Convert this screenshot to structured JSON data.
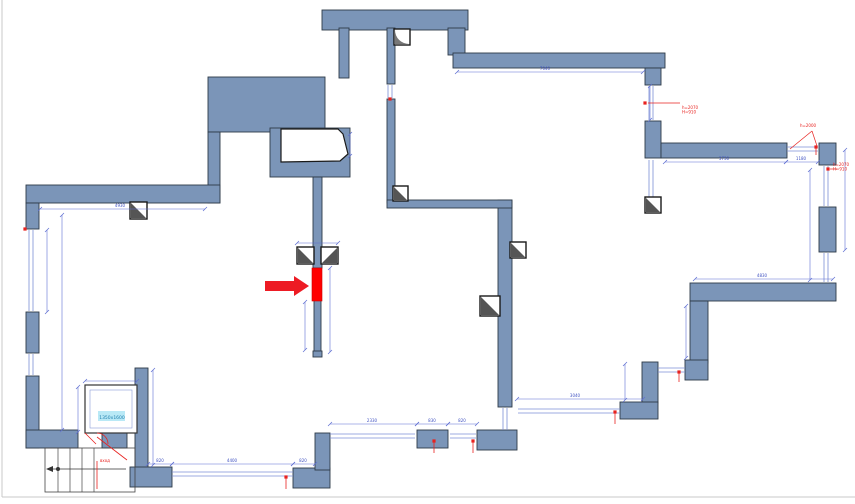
{
  "canvas": {
    "width": 855,
    "height": 504,
    "background": "#ffffff",
    "border_color": "#c9c9c9"
  },
  "colors": {
    "wall_fill": "#7b95b8",
    "wall_stroke": "#2e3a48",
    "thin_wall_fill": "#8aa2c2",
    "dim_line": "#5f6fd2",
    "dim_text": "#3f51c1",
    "window_line": "#7c8fd6",
    "red": "#e8221f",
    "arrow_red": "#ed1b24",
    "highlight_red": "#ff0000",
    "column_dark": "#555555",
    "stair_line": "#444444",
    "label_bg": "#b9e9f6",
    "label_text": "#1f7fae"
  },
  "floor_plan": {
    "walls": [
      [
        322,
        10,
        146,
        20
      ],
      [
        448,
        28,
        17,
        27
      ],
      [
        453,
        53,
        212,
        15
      ],
      [
        645,
        68,
        16,
        17
      ],
      [
        645,
        121,
        16,
        37
      ],
      [
        661,
        143,
        126,
        15
      ],
      [
        819,
        143,
        17,
        22
      ],
      [
        819,
        207,
        17,
        45
      ],
      [
        690,
        283,
        146,
        18
      ],
      [
        690,
        301,
        18,
        62
      ],
      [
        685,
        360,
        23,
        20
      ],
      [
        642,
        362,
        16,
        41
      ],
      [
        620,
        402,
        38,
        17
      ],
      [
        339,
        28,
        10,
        50
      ],
      [
        387,
        28,
        8,
        56
      ],
      [
        387,
        99,
        8,
        104
      ],
      [
        208,
        77,
        117,
        55
      ],
      [
        270,
        128,
        80,
        49
      ],
      [
        208,
        132,
        12,
        71
      ],
      [
        26,
        185,
        194,
        18
      ],
      [
        26,
        203,
        13,
        26
      ],
      [
        26,
        312,
        13,
        41
      ],
      [
        26,
        376,
        13,
        72
      ],
      [
        26,
        430,
        52,
        18
      ],
      [
        102,
        430,
        25,
        18
      ],
      [
        135,
        368,
        13,
        104
      ],
      [
        130,
        467,
        42,
        20
      ],
      [
        293,
        468,
        37,
        20
      ],
      [
        315,
        433,
        15,
        37
      ],
      [
        417,
        430,
        31,
        18
      ],
      [
        477,
        430,
        40,
        20
      ],
      [
        498,
        200,
        14,
        207
      ],
      [
        387,
        200,
        125,
        8
      ],
      [
        313,
        177,
        9,
        91
      ],
      [
        314,
        300,
        7,
        52
      ],
      [
        313,
        351,
        9,
        6
      ]
    ],
    "niche": {
      "points": "281,129 338,129 343,134 348,154 340,161 281,162"
    },
    "windows": [
      [
        31,
        230,
        31,
        311
      ],
      [
        31,
        354,
        31,
        375
      ],
      [
        172,
        474,
        293,
        474
      ],
      [
        330,
        436,
        415,
        436
      ],
      [
        450,
        436,
        476,
        436
      ],
      [
        518,
        411,
        620,
        411
      ],
      [
        658,
        370,
        685,
        370
      ],
      [
        826,
        166,
        826,
        206
      ],
      [
        826,
        253,
        826,
        282
      ],
      [
        651,
        86,
        651,
        120
      ],
      [
        651,
        160,
        651,
        197
      ],
      [
        787,
        149,
        818,
        149
      ],
      [
        505,
        408,
        505,
        430
      ],
      [
        390,
        85,
        390,
        98
      ]
    ],
    "columns": [
      {
        "x": 130,
        "y": 202,
        "s": 17,
        "type": "tri"
      },
      {
        "x": 394,
        "y": 29,
        "s": 16,
        "type": "corner"
      },
      {
        "x": 297,
        "y": 247,
        "s": 17,
        "type": "tri"
      },
      {
        "x": 321,
        "y": 247,
        "s": 17,
        "type": "tri2"
      },
      {
        "x": 393,
        "y": 186,
        "s": 15,
        "type": "tri"
      },
      {
        "x": 510,
        "y": 242,
        "s": 16,
        "type": "tri"
      },
      {
        "x": 480,
        "y": 296,
        "s": 20,
        "type": "tri"
      },
      {
        "x": 645,
        "y": 197,
        "s": 16,
        "type": "tri"
      }
    ],
    "dims": [
      {
        "l": [
          457,
          72,
          643,
          72
        ],
        "label": "7040",
        "tx": 545,
        "ty": 70
      },
      {
        "l": [
          665,
          162,
          786,
          162
        ],
        "label": "3730",
        "tx": 724,
        "ty": 160
      },
      {
        "l": [
          786,
          162,
          818,
          162
        ],
        "label": "1180",
        "tx": 801,
        "ty": 160
      },
      {
        "l": [
          695,
          279,
          833,
          279
        ],
        "label": "4830",
        "tx": 762,
        "ty": 277
      },
      {
        "l": [
          686,
          306,
          686,
          358
        ],
        "label": "",
        "tx": 0,
        "ty": 0
      },
      {
        "l": [
          517,
          399,
          643,
          399
        ],
        "label": "3040",
        "tx": 575,
        "ty": 397
      },
      {
        "l": [
          845,
          150,
          845,
          250
        ],
        "label": "",
        "tx": 0,
        "ty": 0
      },
      {
        "l": [
          40,
          209,
          205,
          209
        ],
        "label": "4930",
        "tx": 120,
        "ty": 207
      },
      {
        "l": [
          47,
          230,
          47,
          312
        ],
        "label": "",
        "tx": 0,
        "ty": 0
      },
      {
        "l": [
          62,
          215,
          62,
          430
        ],
        "label": "",
        "tx": 0,
        "ty": 0
      },
      {
        "l": [
          148,
          464,
          172,
          464
        ],
        "label": "820",
        "tx": 160,
        "ty": 462
      },
      {
        "l": [
          172,
          464,
          293,
          464
        ],
        "label": "4400",
        "tx": 232,
        "ty": 462
      },
      {
        "l": [
          293,
          464,
          315,
          464
        ],
        "label": "820",
        "tx": 303,
        "ty": 462
      },
      {
        "l": [
          330,
          424,
          417,
          424
        ],
        "label": "2330",
        "tx": 372,
        "ty": 422
      },
      {
        "l": [
          417,
          424,
          448,
          424
        ],
        "label": "830",
        "tx": 432,
        "ty": 422
      },
      {
        "l": [
          448,
          424,
          477,
          424
        ],
        "label": "820",
        "tx": 462,
        "ty": 422
      },
      {
        "l": [
          305,
          302,
          305,
          350
        ],
        "label": "",
        "tx": 0,
        "ty": 0
      },
      {
        "l": [
          330,
          268,
          330,
          352
        ],
        "label": "",
        "tx": 0,
        "ty": 0
      },
      {
        "l": [
          153,
          370,
          153,
          465
        ],
        "label": "",
        "tx": 0,
        "ty": 0
      },
      {
        "l": [
          78,
          387,
          78,
          432
        ],
        "label": "",
        "tx": 0,
        "ty": 0
      },
      {
        "l": [
          85,
          381,
          137,
          381
        ],
        "label": "",
        "tx": 0,
        "ty": 0
      },
      {
        "l": [
          810,
          170,
          810,
          280
        ],
        "label": "",
        "tx": 0,
        "ty": 0
      },
      {
        "l": [
          650,
          86,
          650,
          120
        ],
        "label": "",
        "tx": 0,
        "ty": 0
      },
      {
        "l": [
          297,
          243,
          338,
          243
        ],
        "label": "",
        "tx": 0,
        "ty": 0
      },
      {
        "l": [
          625,
          364,
          625,
          400
        ],
        "label": "",
        "tx": 0,
        "ty": 0
      },
      {
        "l": [
          350,
          134,
          350,
          156
        ],
        "label": "",
        "tx": 0,
        "ty": 0
      }
    ],
    "red": {
      "highlight": [
        312,
        268,
        10,
        33
      ],
      "arrow_points": "265,281 294,281 294,276 309,286 294,296 294,291 265,291",
      "markers": [
        {
          "x": 286,
          "y": 477,
          "line": 12
        },
        {
          "x": 434,
          "y": 441,
          "line": 12
        },
        {
          "x": 473,
          "y": 441,
          "line": 12
        },
        {
          "x": 615,
          "y": 412,
          "line": 12
        },
        {
          "x": 679,
          "y": 372,
          "line": 10
        },
        {
          "x": 816,
          "y": 147,
          "line": 8
        },
        {
          "x": 828,
          "y": 169,
          "line": 0
        },
        {
          "x": 645,
          "y": 103,
          "line": 0
        },
        {
          "x": 25,
          "y": 229,
          "line": 0
        },
        {
          "x": 390,
          "y": 99,
          "line": 0
        }
      ],
      "leaders": [
        [
          648,
          103,
          680,
          103
        ],
        [
          790,
          149,
          812,
          131
        ],
        [
          812,
          131,
          817,
          146
        ],
        [
          830,
          169,
          837,
          169
        ]
      ],
      "notes": [
        {
          "x": 682,
          "y": 109,
          "lines": [
            "h=2070",
            "H=910"
          ]
        },
        {
          "x": 800,
          "y": 127,
          "lines": [
            "h=2000"
          ]
        },
        {
          "x": 833,
          "y": 166,
          "lines": [
            "h=2070",
            "H=910"
          ]
        },
        {
          "x": 100,
          "y": 462,
          "lines": [
            "вход"
          ]
        }
      ],
      "door_lines": [
        [
          97,
          437,
          127,
          460
        ],
        [
          97,
          461,
          97,
          489
        ],
        [
          85,
          433,
          96,
          444
        ]
      ],
      "door_arc": "M 97,433 A 11 11 0 0 1 108,444"
    },
    "stairs": {
      "outline": [
        45,
        448,
        90,
        44
      ],
      "treads_x": [
        58,
        70,
        82,
        94
      ],
      "tread_y1": 448,
      "tread_y2": 492,
      "arrow_line": [
        52,
        469,
        126,
        469
      ],
      "arrow_head": "46,469 53,466 53,472",
      "dot": [
        58,
        469
      ]
    },
    "elevator": {
      "outer": [
        85,
        385,
        52,
        48
      ],
      "inner": [
        90,
        390,
        42,
        38
      ],
      "label_box": [
        98,
        411,
        27,
        10
      ],
      "label": "1350x1600",
      "label_x": 112,
      "label_y": 419
    },
    "border_lines": [
      [
        2,
        0,
        2,
        497
      ],
      [
        2,
        497,
        855,
        497
      ]
    ]
  }
}
